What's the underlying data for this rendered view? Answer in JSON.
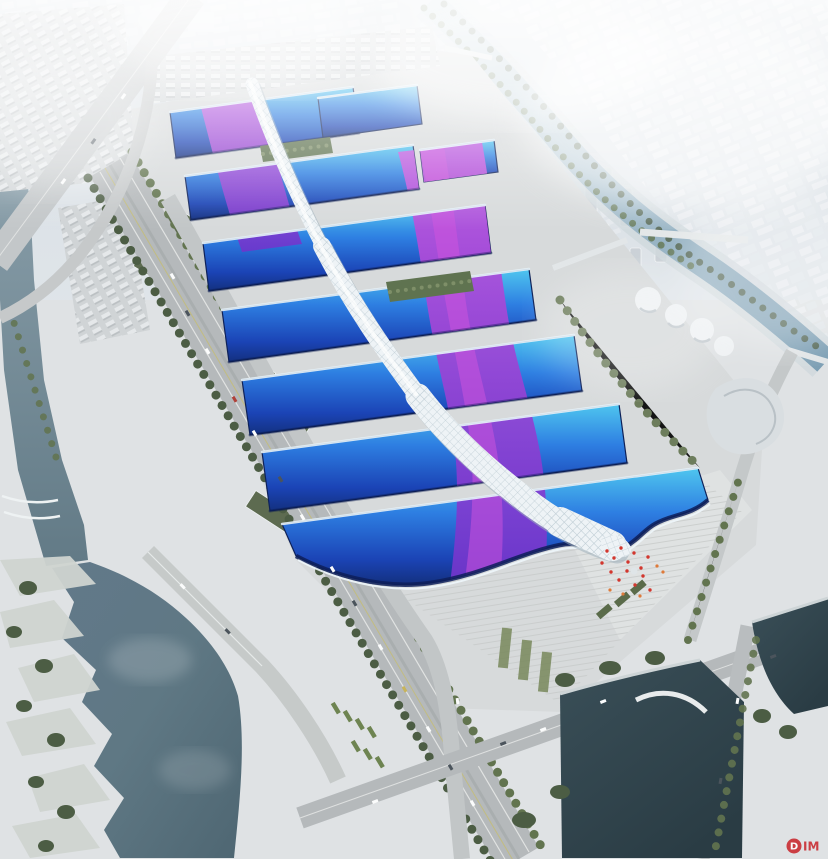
{
  "scene": {
    "type": "architectural-aerial-rendering",
    "subject": "riverside-exhibition-convention-center-complex"
  },
  "palette": {
    "sky_top": "#d7dee4",
    "sky_bottom": "#edf0f2",
    "fog": "#ffffff",
    "city_block": "#eaedf0",
    "tower_gray": "#c9d0d5",
    "ground": "#dfe2e4",
    "deck": "#d7dadb",
    "plaza_light": "#e2e5e5",
    "road": "#b5b9bb",
    "road_light": "#c6c9ca",
    "lane": "#eceeec",
    "lane_yellow": "#c6bd72",
    "tree_dark": "#4c5d44",
    "tree": "#62744f",
    "tree_light": "#7e8f68",
    "lawn": "#78885c",
    "hedge": "#5a6b4a",
    "water_river": "#8da2ad",
    "water_river_deep": "#627a86",
    "water_lake": "#5f7884",
    "water_pond": "#2a3c44",
    "canal_light": "#c3d5de",
    "canal_dark": "#7d9fb4",
    "roof_cyan": "#4fc6ef",
    "roof_blue": "#2e7fe2",
    "roof_deep": "#1b44b6",
    "roof_navy": "#13307f",
    "roof_rim": "#e9f5fb",
    "roof_shadow": "#0a1a4e",
    "ribbon_light": "#c653de",
    "ribbon_dark": "#6f35cc",
    "ribbon_core": "#d254de",
    "spine_white": "#eef3f6",
    "spine_shade": "#9fb1bb",
    "lattice": "#a8bac4",
    "shed_green": "#5d6b50",
    "strip_green": "#5f7350",
    "building_white": "#eef1f3",
    "building_shade": "#c3cacf",
    "bus_green": "#6e8451",
    "crowd_red": "#d2372e",
    "crowd_orange": "#de7a3a",
    "watermark_red": "#c82127"
  },
  "watermark": {
    "badge_letter": "D",
    "text": "IM"
  }
}
